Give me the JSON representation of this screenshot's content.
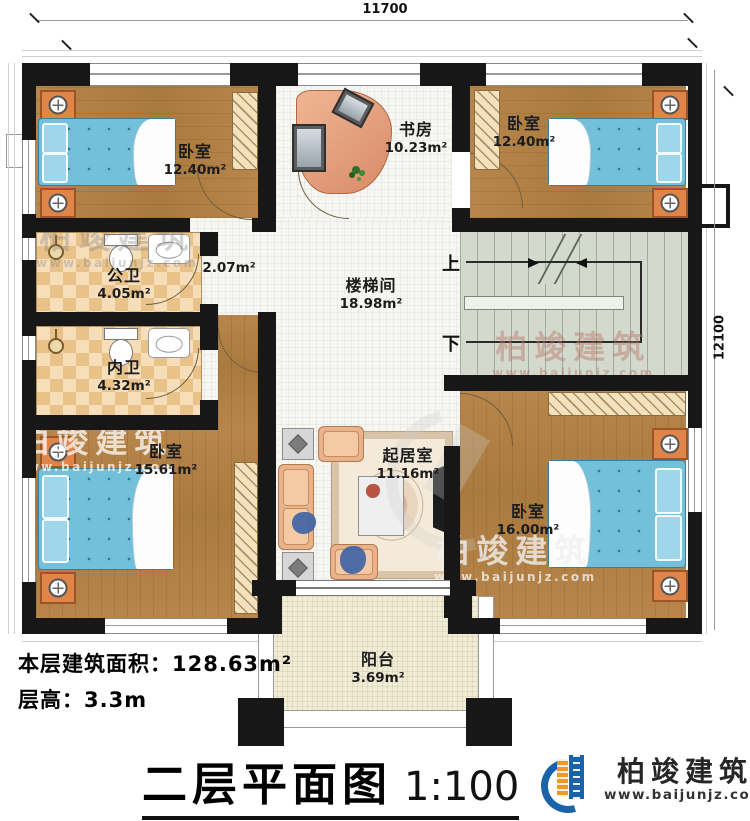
{
  "dimensions": {
    "width": "11700",
    "height": "12100"
  },
  "rooms": {
    "bedroom_tl": {
      "name": "卧室",
      "area": "12.40m²"
    },
    "study": {
      "name": "书房",
      "area": "10.23m²"
    },
    "bedroom_tr": {
      "name": "卧室",
      "area": "12.40m²"
    },
    "hallway": {
      "area": "2.07m²"
    },
    "public_bath": {
      "name": "公卫",
      "area": "4.05m²"
    },
    "private_bath": {
      "name": "内卫",
      "area": "4.32m²"
    },
    "stair_hall": {
      "name": "楼梯间",
      "area": "18.98m²"
    },
    "bedroom_bl": {
      "name": "卧室",
      "area": "15.61m²"
    },
    "living": {
      "name": "起居室",
      "area": "11.16m²"
    },
    "bedroom_br": {
      "name": "卧室",
      "area": "16.00m²"
    },
    "balcony": {
      "name": "阳台",
      "area": "3.69m²"
    }
  },
  "stairs": {
    "up": "上",
    "down": "下"
  },
  "info": {
    "area_label": "本层建筑面积：",
    "area_value": "128.63m²",
    "height_label": "层高：",
    "height_value": "3.3m"
  },
  "title": {
    "name": "二层平面图",
    "scale": "1:100"
  },
  "brand": {
    "name": "柏竣建筑",
    "website": "www.baijunjz.com"
  },
  "watermark": {
    "name": "柏竣建筑",
    "url": "www.baijunjz.com"
  },
  "colors": {
    "wall": "#171717",
    "wood": "#b8854a",
    "bed": "#74c0da",
    "accent_blue": "#1b63a8",
    "accent_orange": "#f0992b"
  }
}
